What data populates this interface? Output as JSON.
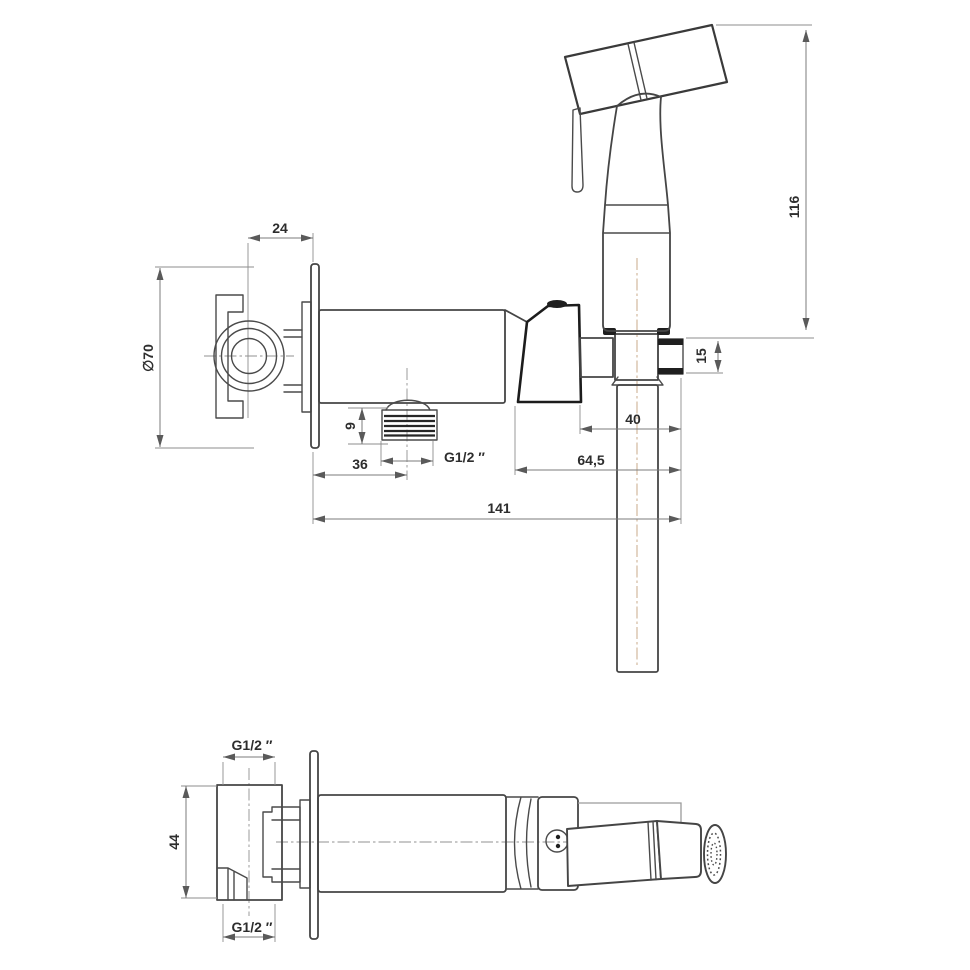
{
  "palette": {
    "outline": "#454545",
    "heavy_outline": "#1c1c1c",
    "dimension_line": "#7b7b7b",
    "text": "#2d2d2d",
    "centerline": "#919191",
    "centerline_accent": "#cdb295",
    "background": "#ffffff"
  },
  "front_view": {
    "label": "front elevation of bidet sprayer set",
    "dims": {
      "plate_offset": "24",
      "plate_diameter": "∅70",
      "sprayer_height": "116",
      "holder_height": "15",
      "holder_width": "40",
      "outlet_height": "9",
      "outlet_offset": "36",
      "outlet_thread": "G1/2 ″",
      "holder_offset": "64,5",
      "total_width": "141"
    }
  },
  "plan_view": {
    "label": "plan view of bidet sprayer set",
    "dims": {
      "inlet_thread_top": "G1/2 ″",
      "body_height": "44",
      "inlet_thread_bottom": "G1/2 ″"
    }
  }
}
